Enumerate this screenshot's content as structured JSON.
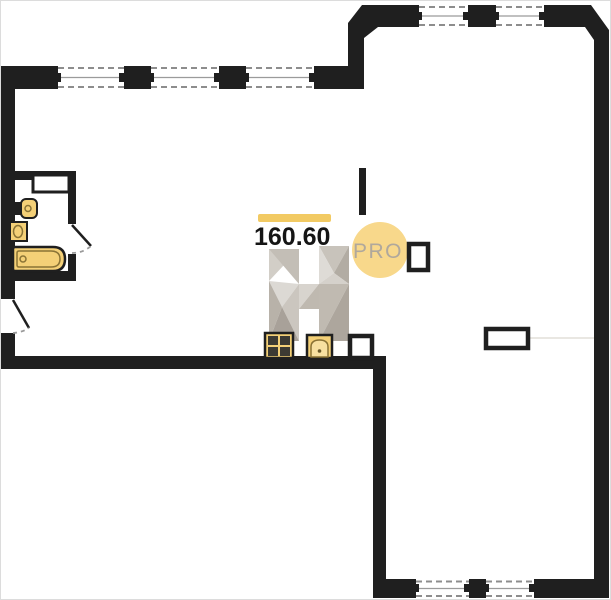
{
  "labels": {
    "area_value": "160.60",
    "badge": "PRO",
    "watermark_letter": "H"
  },
  "colors": {
    "walls": "#1f1f1f",
    "accent": "#f2ca63",
    "badge_fill": "#f8d88b",
    "badge_text": "#b0a89c",
    "fixtures": "#f4d077",
    "fixture_detail": "#8a7335",
    "window_dash": "#8d8d8d",
    "watermark_grays": [
      "#d2cec7",
      "#c3beb6",
      "#dcd9d4",
      "#b8b2a9",
      "#cbc6bf",
      "#a8a199"
    ]
  },
  "plan": {
    "type": "floor-plan",
    "total_area": "160.60",
    "bathroom_fixtures": [
      "washing-machine-niche",
      "toilet",
      "sink",
      "bathtub"
    ],
    "kitchen_fixtures": [
      "stove",
      "oven",
      "vent-shaft"
    ],
    "hall_fixtures": [
      "vent-shaft",
      "wall-niche"
    ],
    "windows": {
      "top_left_wall": 3,
      "top_right_wall": 2,
      "bottom_wall": 2
    },
    "doors": [
      "entrance-door",
      "bathroom-door"
    ]
  }
}
